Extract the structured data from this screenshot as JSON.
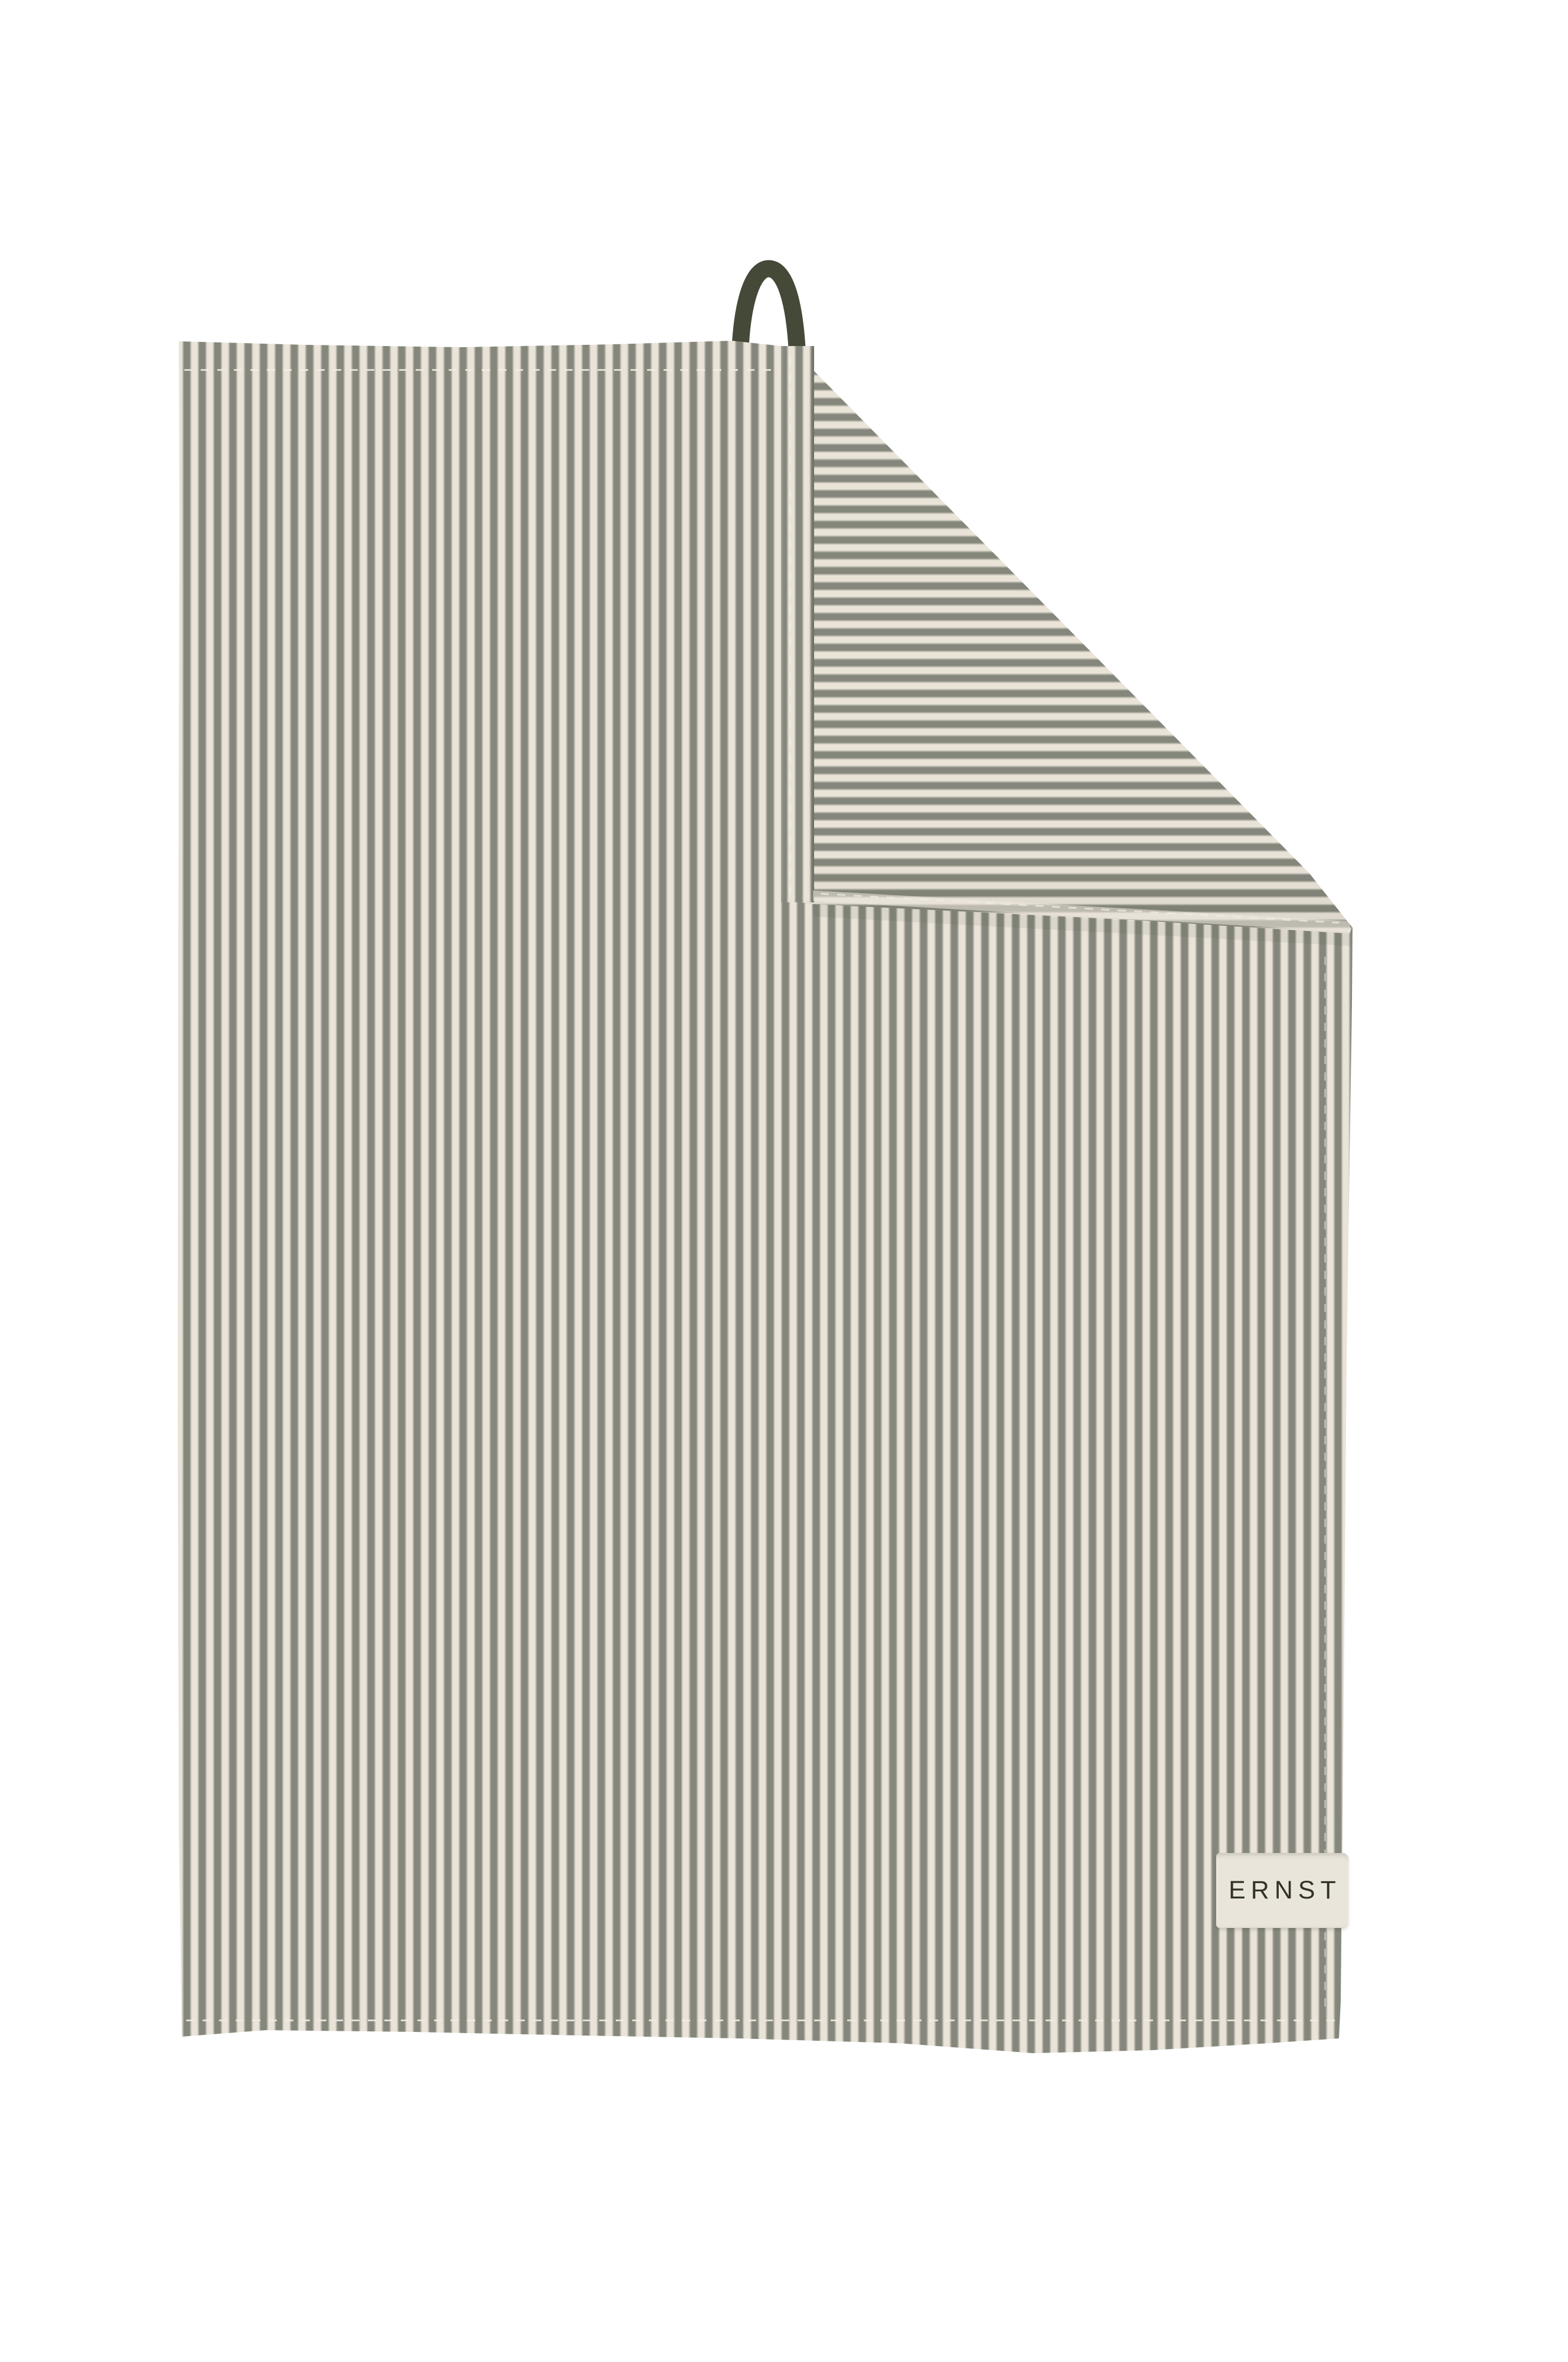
{
  "product_photo": {
    "description": "Hanging striped kitchen towel with its top-right corner folded over, revealing horizontal stripes on the reverse side; dark olive-green hanging loop at the top; cream woven brand label sewn into the lower-right hem.",
    "brand_label": {
      "text": "ERNST"
    },
    "colors": {
      "background": "#ffffff",
      "stripe_dark": "#85877c",
      "stripe_light": "#e9e3d8",
      "loop": "#454938",
      "label_bg": "#eae5da",
      "label_text": "#32322b",
      "stitch": "#f1ede3"
    }
  }
}
